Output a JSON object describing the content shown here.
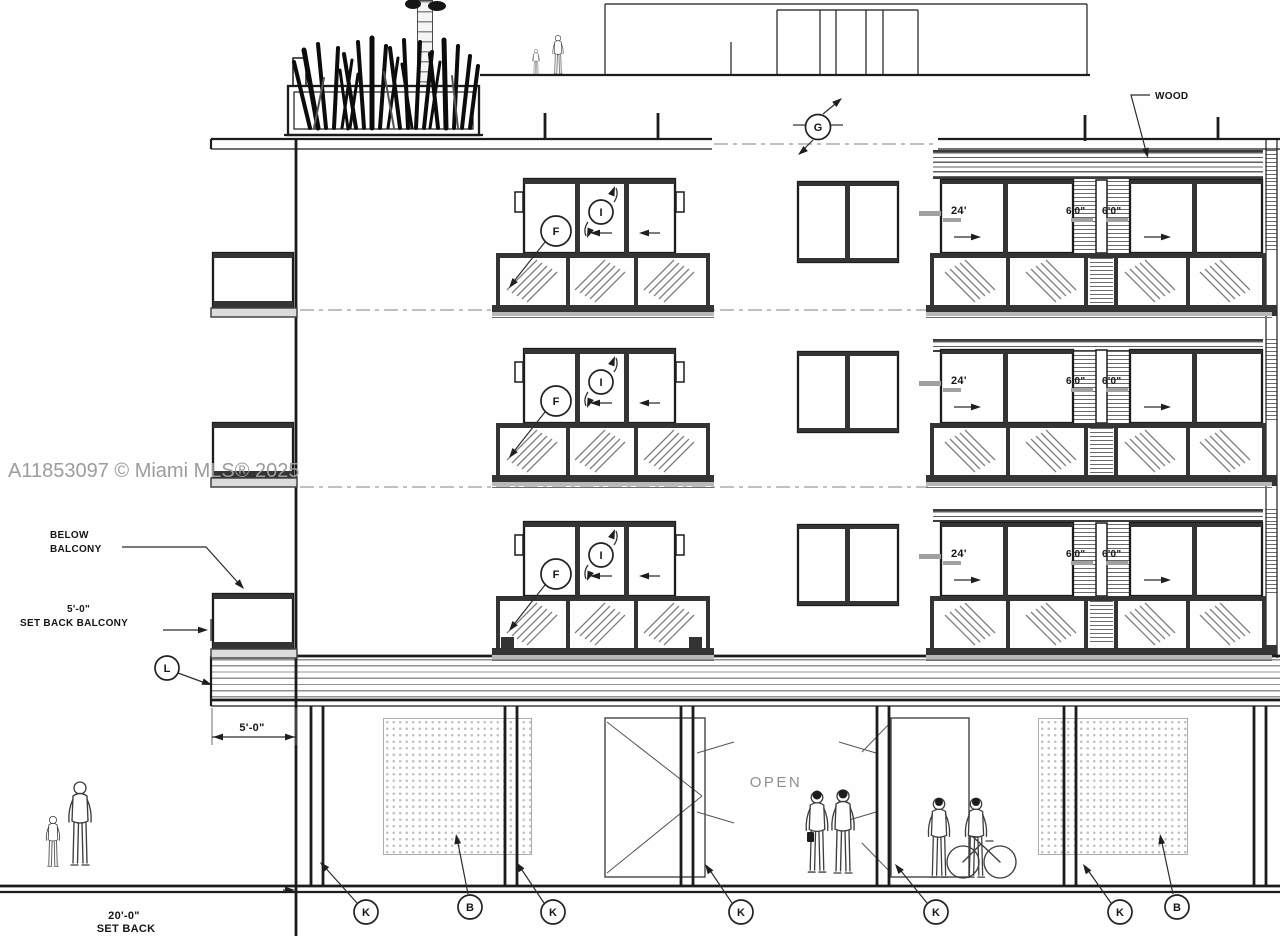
{
  "watermark": "A11853097 © Miami MLS® 2025",
  "annotations": {
    "wood": "WOOD",
    "open": "OPEN",
    "below_balcony_1": "BELOW",
    "below_balcony_2": "BALCONY",
    "setback_balcony_dim": "5'-0\"",
    "setback_balcony_text": "SET BACK BALCONY",
    "balcony_depth_dim": "5'-0\"",
    "ground_setback_dim": "20'-0\"",
    "ground_setback_text": "SET BACK",
    "door_width": "24'",
    "small_door_width": "6'0\""
  },
  "markers": {
    "section": "G",
    "railing_detail": "F",
    "door_swing": "I",
    "slab_edge": "L",
    "column": "K",
    "screen_wall": "B"
  }
}
